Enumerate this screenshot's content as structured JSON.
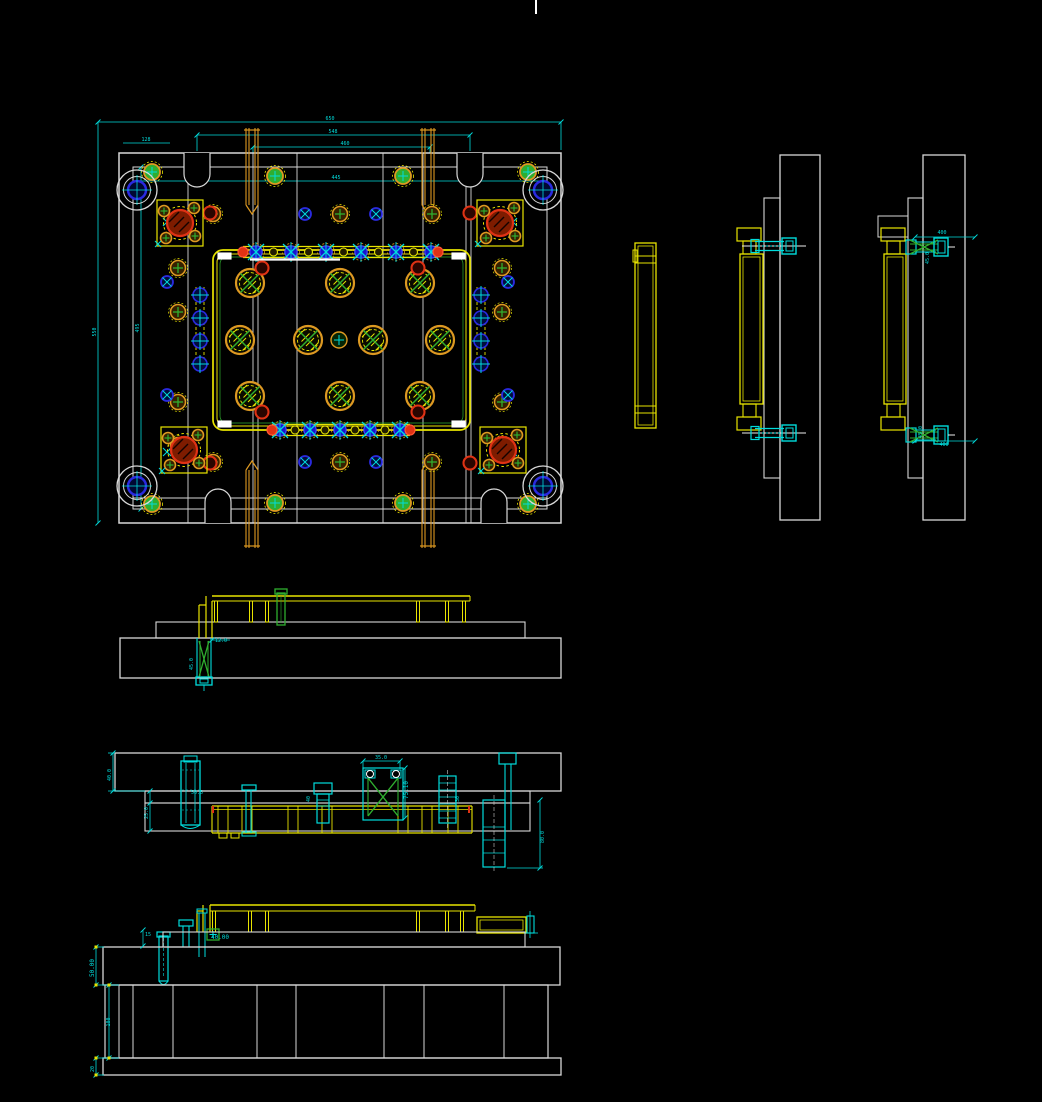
{
  "canvas": {
    "background": "#000000",
    "cursor_tick": {
      "x": 535,
      "y": 0,
      "h": 14
    }
  },
  "colors": {
    "outline_white": "#d8d8d8",
    "dimension_cyan": "#00dcdc",
    "plate_yellow": "#e8e400",
    "component_orange": "#dd9922",
    "alert_red": "#e03214",
    "pin_green": "#2fae2f",
    "bushing_blue": "#2a2ae0",
    "bushing_fill": "#000d3d"
  },
  "plan_view": {
    "hatched_support_circles": [
      [
        250,
        283
      ],
      [
        340,
        283
      ],
      [
        420,
        283
      ],
      [
        240,
        340
      ],
      [
        308,
        340
      ],
      [
        373,
        340
      ],
      [
        440,
        340
      ],
      [
        250,
        396
      ],
      [
        340,
        396
      ],
      [
        420,
        396
      ]
    ],
    "small_center_circle": [
      339,
      340
    ],
    "guide_pillars": [
      [
        137,
        190
      ],
      [
        543,
        190
      ],
      [
        137,
        486
      ],
      [
        543,
        486
      ]
    ],
    "corner_lock_units": [
      [
        180,
        223
      ],
      [
        500,
        223
      ],
      [
        184,
        450
      ],
      [
        503,
        450
      ]
    ],
    "lift_ring_circles": [
      [
        152,
        172
      ],
      [
        528,
        172
      ],
      [
        152,
        504
      ],
      [
        528,
        504
      ],
      [
        275,
        176
      ],
      [
        403,
        176
      ],
      [
        275,
        503
      ],
      [
        403,
        503
      ]
    ],
    "screw_circles": [
      [
        213,
        214
      ],
      [
        340,
        214
      ],
      [
        432,
        214
      ],
      [
        213,
        462
      ],
      [
        340,
        462
      ],
      [
        432,
        462
      ],
      [
        178,
        268
      ],
      [
        178,
        312
      ],
      [
        178,
        402
      ],
      [
        178,
        445
      ],
      [
        502,
        268
      ],
      [
        502,
        312
      ],
      [
        502,
        402
      ],
      [
        502,
        445
      ]
    ],
    "bushing_circles": [
      [
        305,
        214
      ],
      [
        376,
        214
      ],
      [
        305,
        462
      ],
      [
        376,
        462
      ],
      [
        167,
        282
      ],
      [
        508,
        282
      ],
      [
        167,
        395
      ],
      [
        508,
        395
      ]
    ],
    "oring_circles": [
      [
        210,
        213
      ],
      [
        470,
        213
      ],
      [
        210,
        463
      ],
      [
        470,
        463
      ],
      [
        262,
        268
      ],
      [
        418,
        268
      ],
      [
        262,
        412
      ],
      [
        418,
        412
      ]
    ],
    "x_marks": [
      [
        167,
        222
      ],
      [
        513,
        222
      ],
      [
        167,
        452
      ],
      [
        513,
        452
      ]
    ],
    "top_manifold": {
      "x1": 243,
      "x2": 438,
      "y": 252,
      "fittings": [
        256,
        291,
        326,
        361,
        396,
        431
      ]
    },
    "bottom_manifold": {
      "x1": 272,
      "x2": 410,
      "y": 430,
      "fittings": [
        280,
        310,
        340,
        370,
        400
      ]
    },
    "side_channels": {
      "left_x": 200,
      "right_x": 481,
      "ys": [
        295,
        318,
        341,
        364
      ]
    }
  },
  "dimension_labels": [
    {
      "t": "650",
      "x": 330,
      "y": 120,
      "r": 0
    },
    {
      "t": "548",
      "x": 333,
      "y": 133,
      "r": 0
    },
    {
      "t": "460",
      "x": 345,
      "y": 145,
      "r": 0
    },
    {
      "t": "128",
      "x": 146,
      "y": 141,
      "r": 0
    },
    {
      "t": "445",
      "x": 336,
      "y": 179,
      "r": 0
    },
    {
      "t": "550",
      "x": 96,
      "y": 332,
      "r": -90
    },
    {
      "t": "495",
      "x": 139,
      "y": 328,
      "r": -90
    },
    {
      "t": "400",
      "x": 942,
      "y": 234,
      "r": 0
    },
    {
      "t": "45.0",
      "x": 929,
      "y": 258,
      "r": -90
    },
    {
      "t": "400",
      "x": 944,
      "y": 446,
      "r": 0
    },
    {
      "t": "45.0",
      "x": 922,
      "y": 432,
      "r": -90
    },
    {
      "t": "12.0",
      "x": 221,
      "y": 642,
      "r": 0
    },
    {
      "t": "45.0",
      "x": 193,
      "y": 664,
      "r": -90
    },
    {
      "t": "40.0",
      "x": 111,
      "y": 775,
      "r": -90
    },
    {
      "t": "35.0",
      "x": 381,
      "y": 759,
      "r": 0
    },
    {
      "t": "75.10",
      "x": 408,
      "y": 790,
      "r": -90
    },
    {
      "t": "50.5",
      "x": 197,
      "y": 794,
      "r": 0
    },
    {
      "t": "25.0",
      "x": 148,
      "y": 813,
      "r": -90
    },
    {
      "t": "40",
      "x": 310,
      "y": 799,
      "r": -90
    },
    {
      "t": "30",
      "x": 459,
      "y": 799,
      "r": -90
    },
    {
      "t": "80.0",
      "x": 544,
      "y": 837,
      "r": -90
    },
    {
      "t": "15",
      "x": 148,
      "y": 936,
      "r": 0
    },
    {
      "t": "40.00",
      "x": 220,
      "y": 939,
      "r": 0
    },
    {
      "t": "50.00",
      "x": 94,
      "y": 968,
      "r": -90
    },
    {
      "t": "100",
      "x": 110,
      "y": 1022,
      "r": -90
    },
    {
      "t": "20",
      "x": 94,
      "y": 1069,
      "r": -90
    }
  ]
}
